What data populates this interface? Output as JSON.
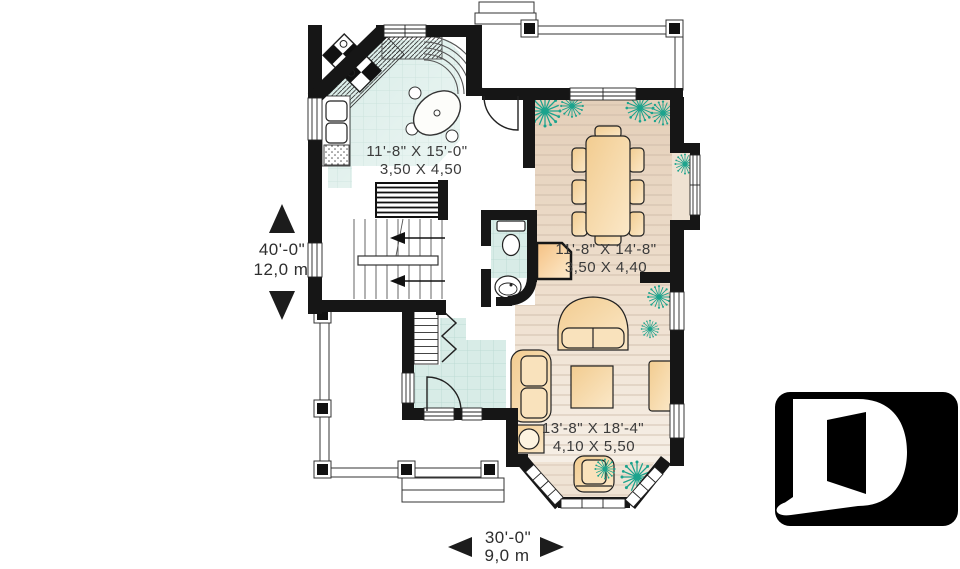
{
  "plan": {
    "rooms": [
      {
        "id": "kitchen",
        "imperial": "11'-8\" X 15'-0\"",
        "metric": "3,50 X 4,50"
      },
      {
        "id": "dining-room",
        "imperial": "11'-8\" X 14'-8\"",
        "metric": "3,50 X 4,40"
      },
      {
        "id": "living-room",
        "imperial": "13'-8\" X 18'-4\"",
        "metric": "4,10 X 5,50"
      }
    ],
    "overall_dimensions": {
      "depth_imperial": "40'-0\"",
      "depth_metric": "12,0 m",
      "width_imperial": "30'-0\"",
      "width_metric": "9,0 m"
    },
    "icons": {
      "plant": "plant-icon",
      "logo": "d-logo-icon",
      "up_arrow": "up-arrow-icon",
      "down_arrow": "down-arrow-icon",
      "left_arrow": "left-arrow-icon",
      "right_arrow": "right-arrow-icon"
    },
    "colors": {
      "wall": "#161616",
      "kitchen_tile": "#d8ece7",
      "floor_beige": "#e5d0ba",
      "furniture": "#f3cd92",
      "plant": "#1ca38d",
      "label_text": "#3b3b3b",
      "logo_background": "#000000",
      "logo_letter": "#ffffff"
    }
  }
}
